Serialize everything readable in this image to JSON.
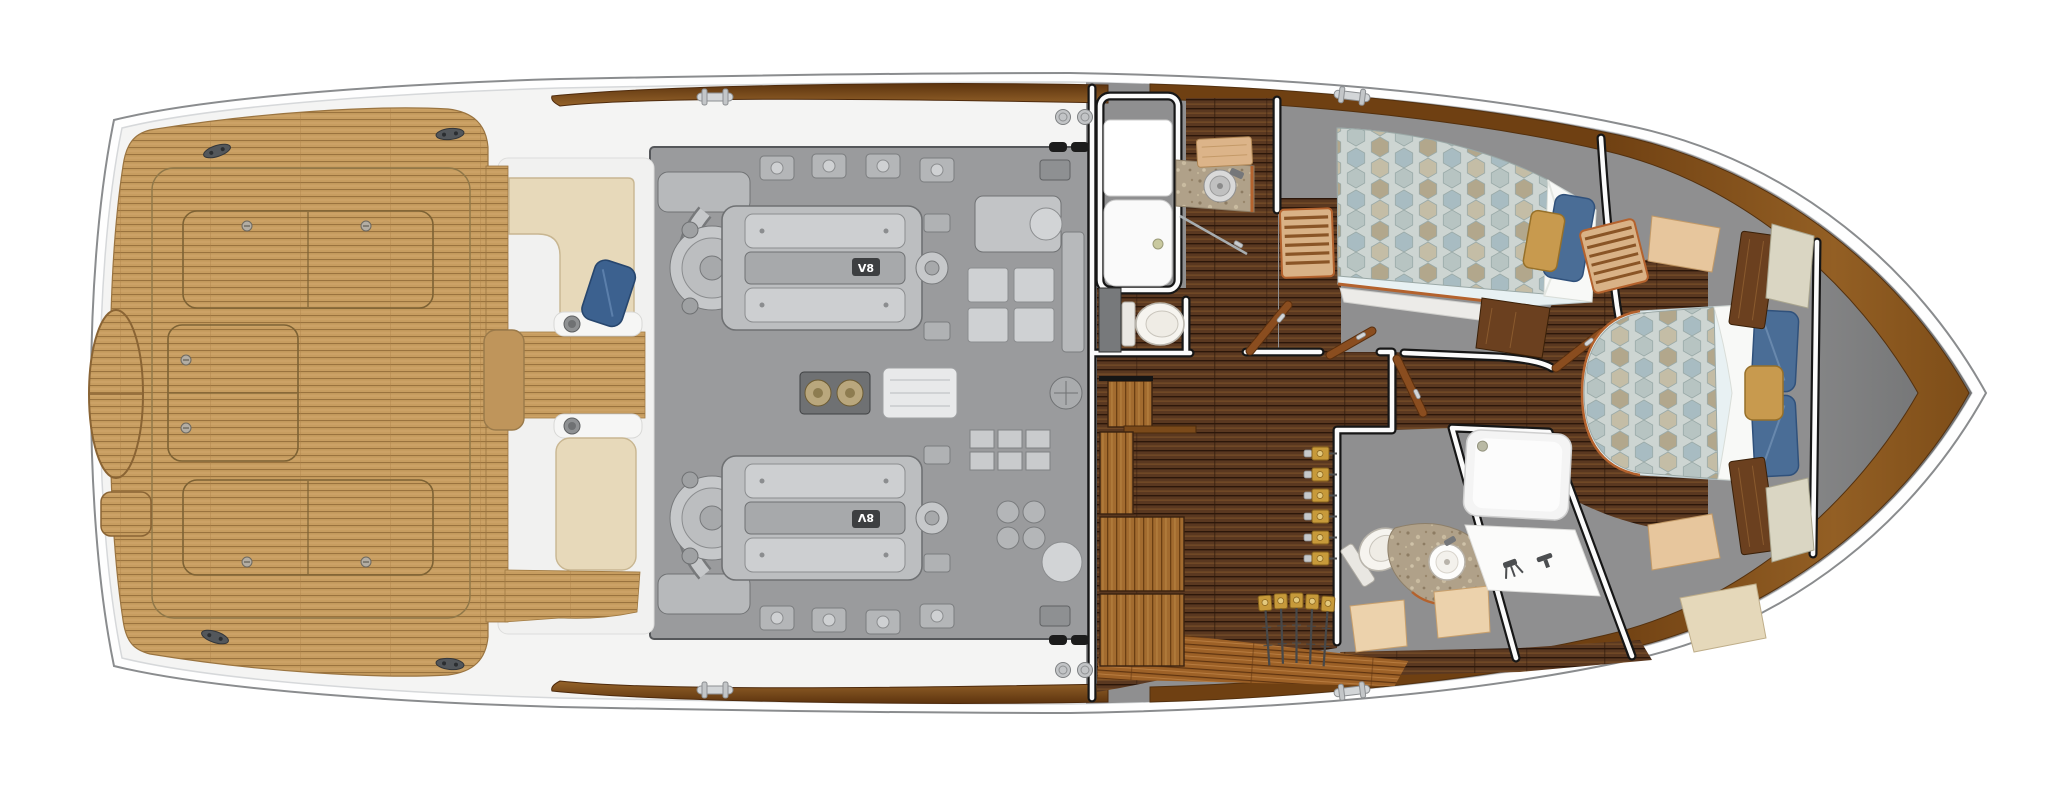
{
  "scene": {
    "description": "Top-down yacht interior deck plan, bow pointing right",
    "background": "#FFFFFF"
  },
  "engine_room": {
    "badge": "V8",
    "engine_count": 2
  },
  "palette": {
    "hull_white": "#FEFEFE",
    "deck_white": "#F4F4F3",
    "teak": "#C79D60",
    "teak_line": "#9A733E",
    "walnut_floor": "#5A3820",
    "walnut_light": "#9D6127",
    "engine_bay_gray": "#9A9B9D",
    "machinery_gray": "#C2C4C6",
    "interior_wall_gray": "#8F8F90",
    "bow_gray": "#6F7071",
    "rub_rail_wood": "#935F24",
    "cream_upholstery": "#E7D9BA",
    "sage_upholstery": "#D9D5C2",
    "maple_wood": "#E6C49B",
    "navy_pillow": "#3C618F",
    "slate_blue_pillow": "#4A6D96",
    "gold_pillow": "#C89A4E",
    "duvet_fabric": "#CDD5D2",
    "granite_counter": "#B0A189",
    "accent_trim": "#B4622D",
    "reel_gold": "#C79A3A",
    "hardware_silver": "#D3D6D8"
  },
  "counts": {
    "cockpit_hatches": 3,
    "cockpit_cleats": 4,
    "deck_cleats": 4,
    "deck_fills": 4,
    "forward_rod_rack_rods": 6,
    "aft_rod_rack_rods": 5,
    "toilets": 2,
    "showers": 2,
    "sinks": 2,
    "beds": 2,
    "cabins": 2,
    "heads": 2,
    "engines": 2
  }
}
